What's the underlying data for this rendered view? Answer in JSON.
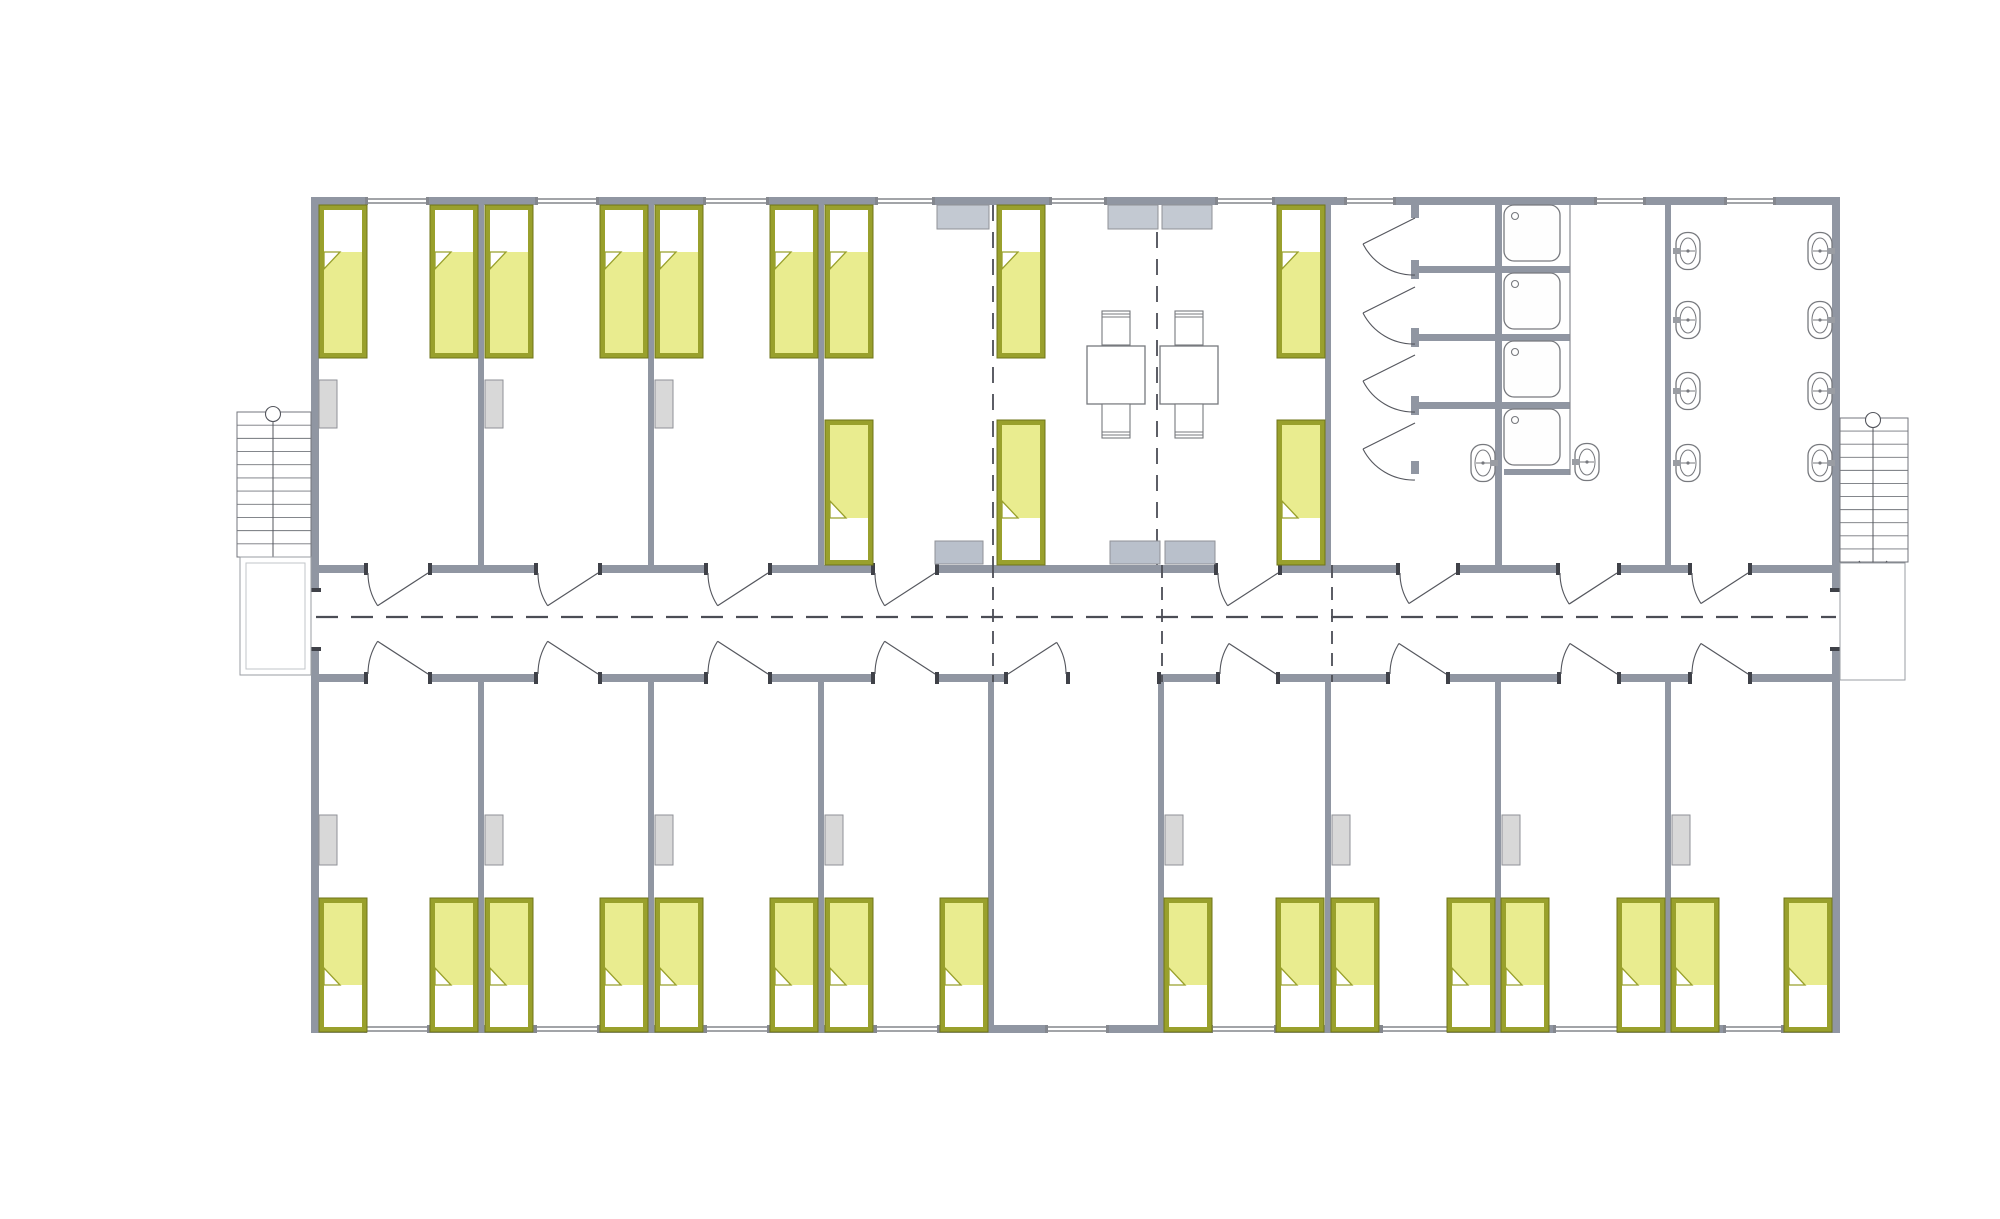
{
  "page": {
    "type": "architectural floor plan",
    "subject": "dormitory module – furnished level plan",
    "background": "#ffffff"
  },
  "watermark": {
    "text": "VANDA",
    "pink_panel": "#f2b0bd",
    "blue_panel": "#b7d8ec",
    "text_color": "#ffffff"
  },
  "dimensions": {
    "top_total": "21 600",
    "top_bays": [
      "2 400",
      "2 400",
      "2 400",
      "2 400",
      "2 400",
      "2 400",
      "2 400",
      "2 400",
      "2 400"
    ],
    "left_total": "12 000",
    "left_segments": [
      "5 250",
      "1 500",
      "5 250"
    ]
  },
  "colors": {
    "wall": "#9096a2",
    "jamb": "#3f4148",
    "bed_frame": "#99a02c",
    "bed_mattress": "#e9ec8f",
    "pillow": "#ffffff",
    "wardrobe": "#d8d8d8",
    "counter": "#c3c9d2",
    "fixture_stroke": "#77797e",
    "dash_color": "#4b4d55",
    "dim_color": "#161616"
  },
  "inventory": {
    "beds_total": 28,
    "beds_upper_band": 12,
    "beds_lower_band": 16,
    "shower_cubicles": 4,
    "shower_trays": 4,
    "washbasins": 10,
    "dining_tables": 2,
    "chairs": 4,
    "wardrobes": 11,
    "counters": 6,
    "staircases_exterior": 2,
    "staircases_interior": 1,
    "corridor": 1
  }
}
